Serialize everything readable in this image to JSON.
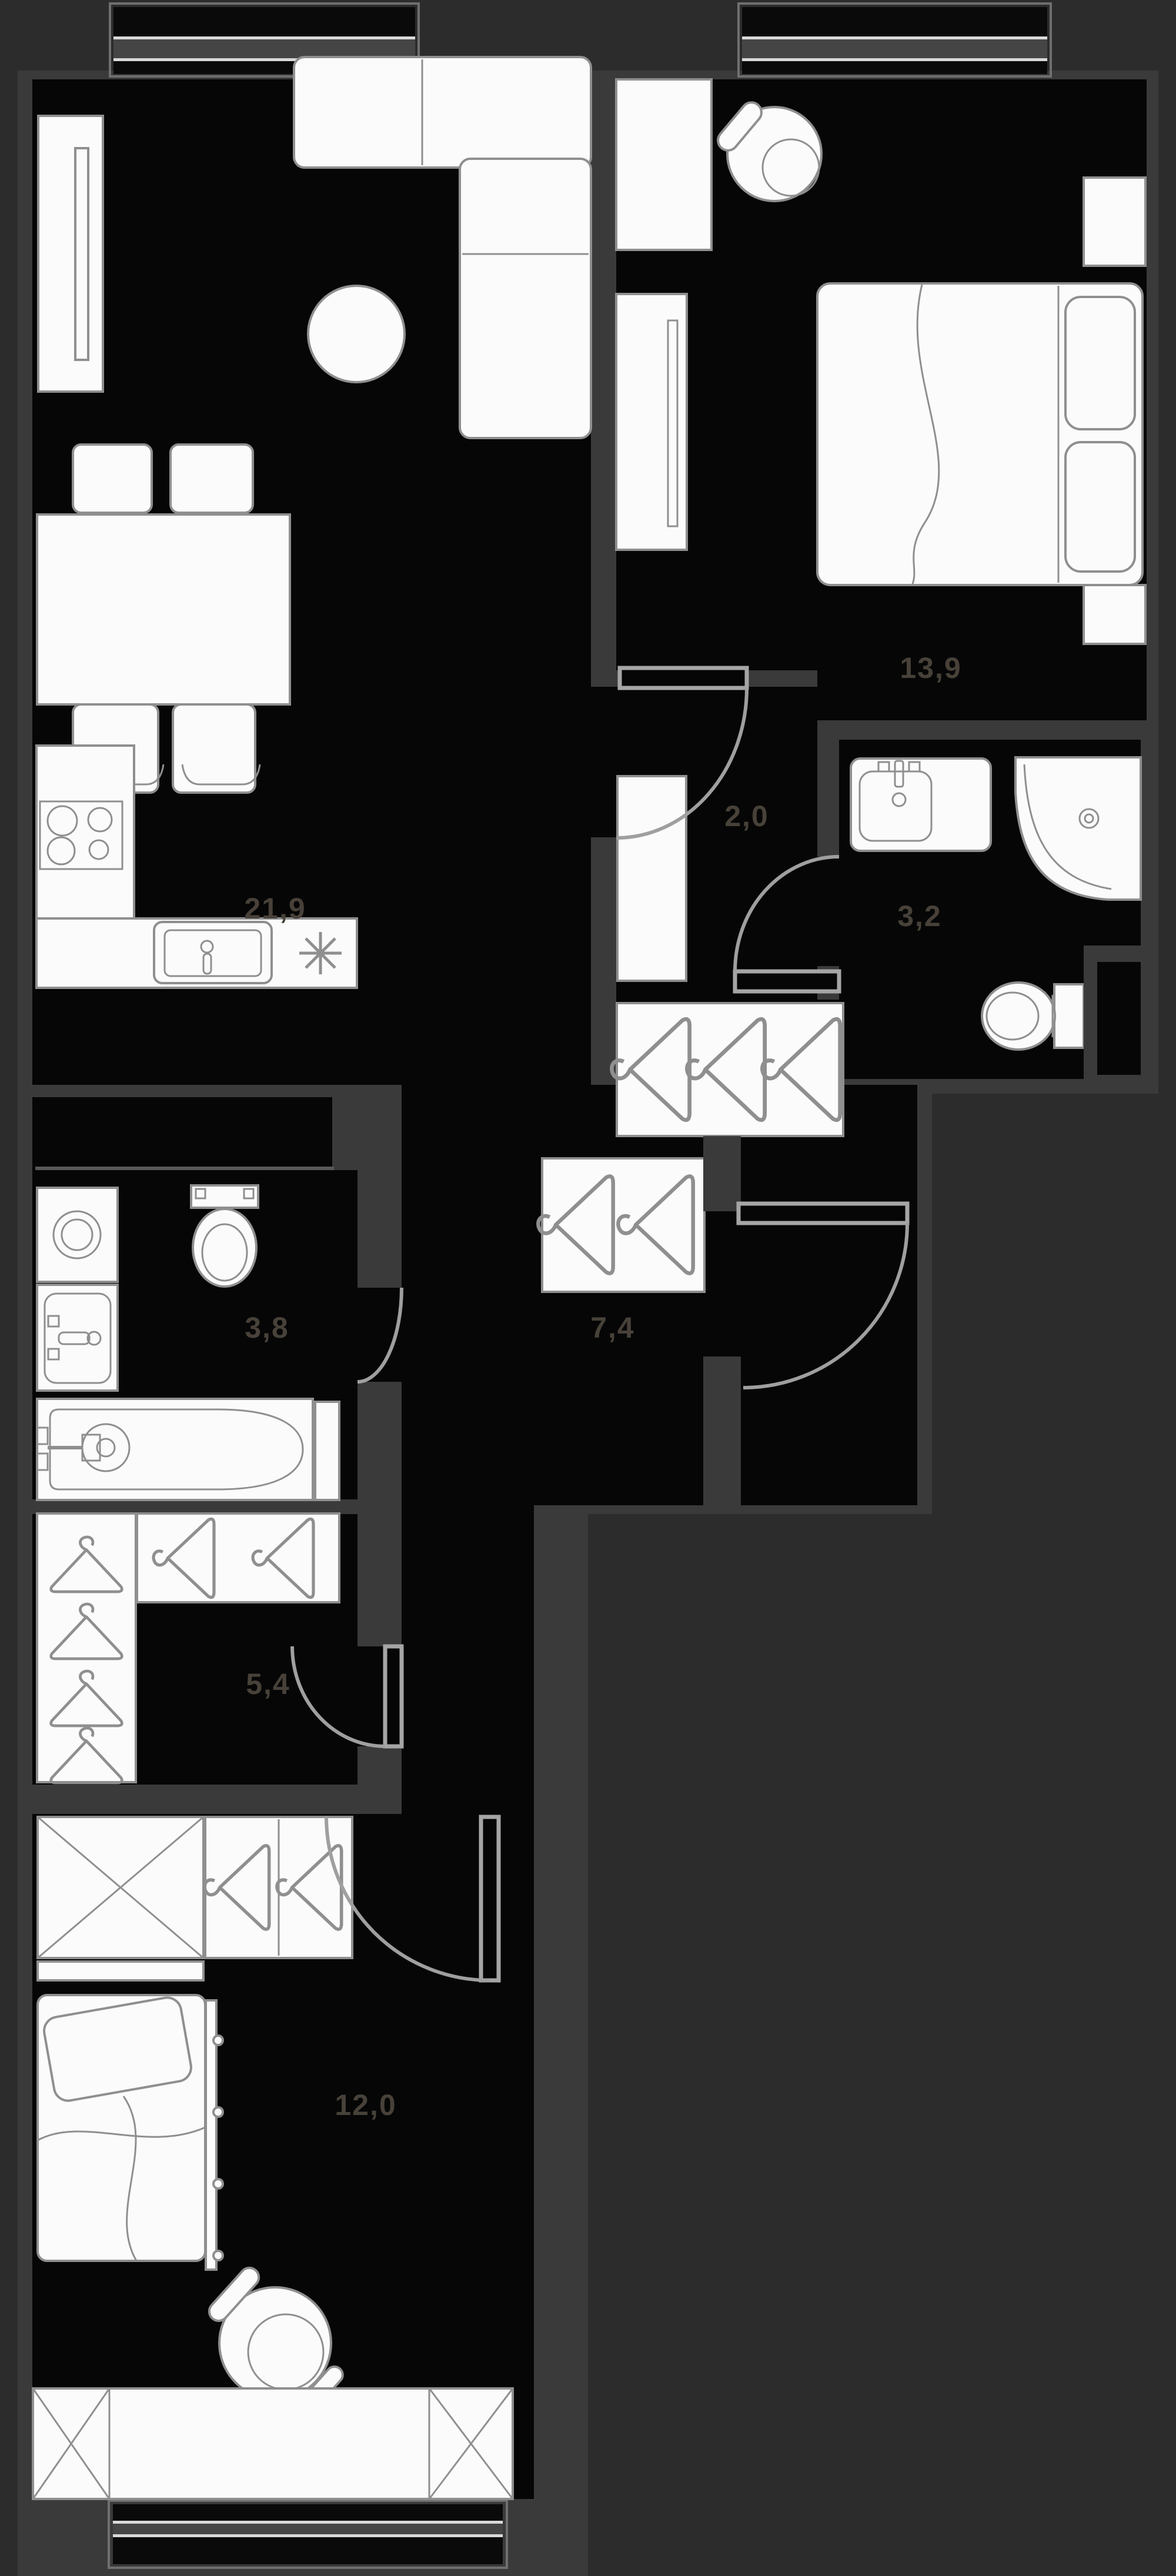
{
  "plan": {
    "colors": {
      "background": "#2c2c2c",
      "wall": "#3a3a3a",
      "floor": "#060606",
      "furniture_fill": "#fbfbfb",
      "furniture_outline": "#8f8f8f",
      "door_arc": "#9f9f9f",
      "label_text": "#474139"
    },
    "rooms": [
      {
        "id": "living-kitchen",
        "area_label": "21,9"
      },
      {
        "id": "bedroom-main",
        "area_label": "13,9"
      },
      {
        "id": "vestibule",
        "area_label": "2,0"
      },
      {
        "id": "bathroom-shower",
        "area_label": "3,2"
      },
      {
        "id": "bathroom-main",
        "area_label": "3,8"
      },
      {
        "id": "hallway",
        "area_label": "7,4"
      },
      {
        "id": "wardrobe-room",
        "area_label": "5,4"
      },
      {
        "id": "bedroom-second",
        "area_label": "12,0"
      }
    ]
  }
}
